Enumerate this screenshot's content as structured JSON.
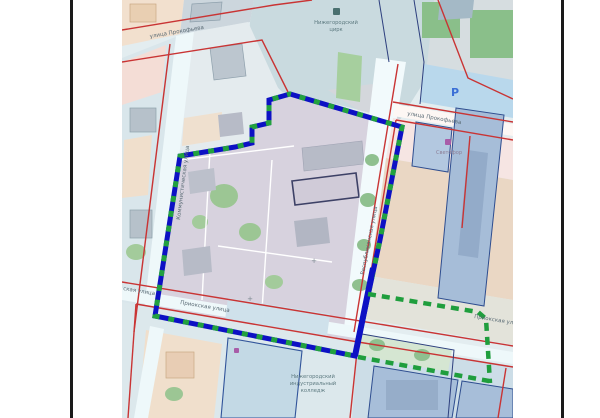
{
  "map": {
    "streets": {
      "prokofyeva_top": "улица Прокофьева",
      "prokofyeva_right": "улица Прокофьева",
      "kommunisticheskaya": "Коммунистическая улица",
      "respublikanskaya": "Республиканская улица",
      "priokskaya": "Приокская улица",
      "priokskaya_right": "Приокская улица",
      "partial_left": "ская улица"
    },
    "pois": {
      "circus_line1": "Нижегородский",
      "circus_line2": "цирк",
      "svetofor": "Светофор",
      "college_line1": "Нижегородский",
      "college_line2": "индустриальный",
      "college_line3": "колледж",
      "parking_symbol": "P",
      "plus_marker": "+"
    },
    "colors": {
      "boundary_blue": "#0d11c4",
      "boundary_dash_green": "#22a13f",
      "planned_boundary_green": "#1f9e3d",
      "cadastral_line_red": "#c93434",
      "parcel_line_navy": "#2d3f7e",
      "frame_border_black": "#1a1a1a"
    }
  }
}
